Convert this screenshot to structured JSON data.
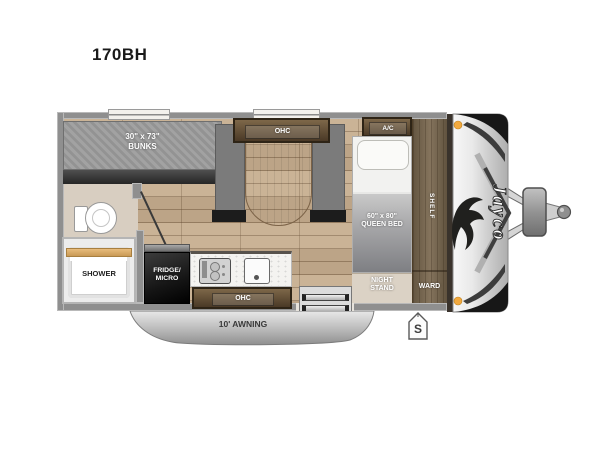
{
  "page": {
    "title": "170BH"
  },
  "colors": {
    "wall": "#8f8f8f",
    "floor_wood": "#c6ad8e",
    "bath_floor": "#d8cec1",
    "cabinet_dark": "#4a3926",
    "cabinet_light": "#7d6749",
    "seat_gray": "#7b7b7b",
    "mattress_gray": "#9b9b9b",
    "bed_blanket": "#85868a",
    "night_stand_tan": "#dbd2c5",
    "fridge_black": "#141414",
    "awning_silver": "#c9c9c9",
    "front_cap_silver": "#d6d6d6",
    "amber_light": "#f2a93e"
  },
  "floorplan": {
    "bunks": {
      "size": "30\" x 73\"",
      "name": "BUNKS"
    },
    "dinette": {
      "ohc": "OHC"
    },
    "ac": "A/C",
    "queen_bed": {
      "size": "60\" x 80\"",
      "name": "QUEEN BED"
    },
    "shelf": "SHELF",
    "night_stand": {
      "line1": "NIGHT",
      "line2": "STAND"
    },
    "ward": "WARD",
    "shower": "SHOWER",
    "fridge": {
      "line1": "FRIDGE/",
      "line2": "MICRO"
    },
    "kitchen": {
      "ohc": "OHC"
    },
    "awning": "10' AWNING",
    "s_badge": "S",
    "brand": "Jayco"
  }
}
